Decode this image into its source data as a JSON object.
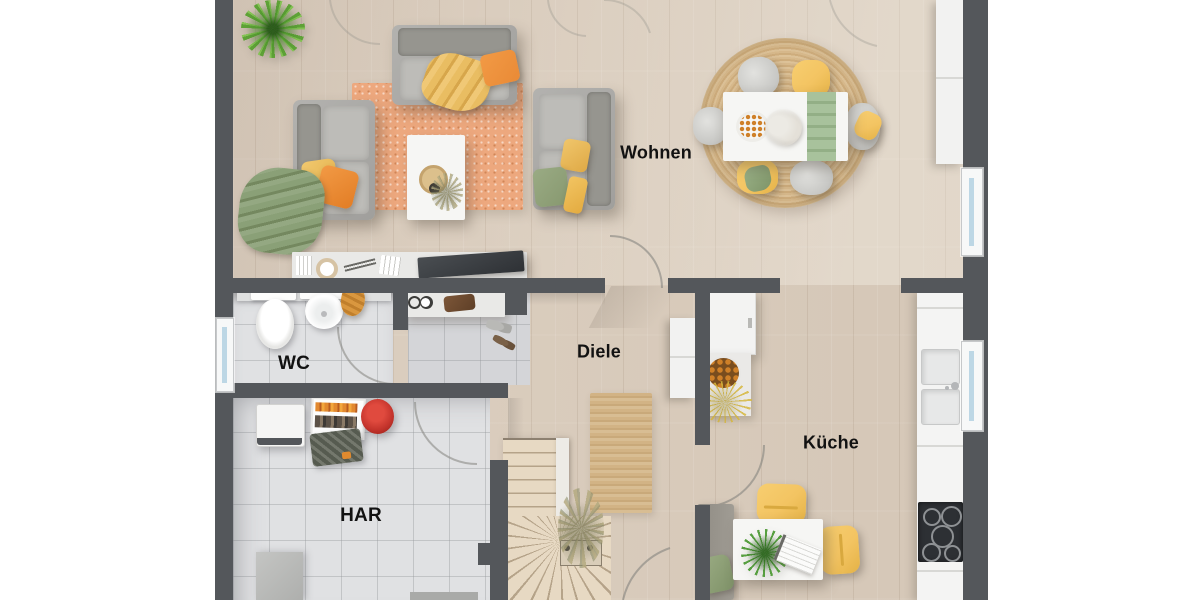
{
  "rooms": {
    "wohnen": {
      "label": "Wohnen"
    },
    "diele": {
      "label": "Diele"
    },
    "wc": {
      "label": "WC"
    },
    "har": {
      "label": "HAR"
    },
    "kueche": {
      "label": "Küche"
    }
  },
  "theme": {
    "background": "#ffffff",
    "wall": "#54575b",
    "wood": "#d8cabb",
    "tile": "#e0e1e3",
    "rug_orange": "#eda87e",
    "jute": "#d3b68a",
    "sofa_gray": "#a9a8a5",
    "pillow_orange": "#e98a36",
    "pillow_yellow": "#edc268",
    "accent_green": "#87986f",
    "table": "#f6f6f4",
    "chair_yellow": "#f3c462",
    "glass": "#bdd7e5",
    "cooktop": "#2d3034",
    "vacuum_red": "#c4342c",
    "label": "#121212"
  }
}
